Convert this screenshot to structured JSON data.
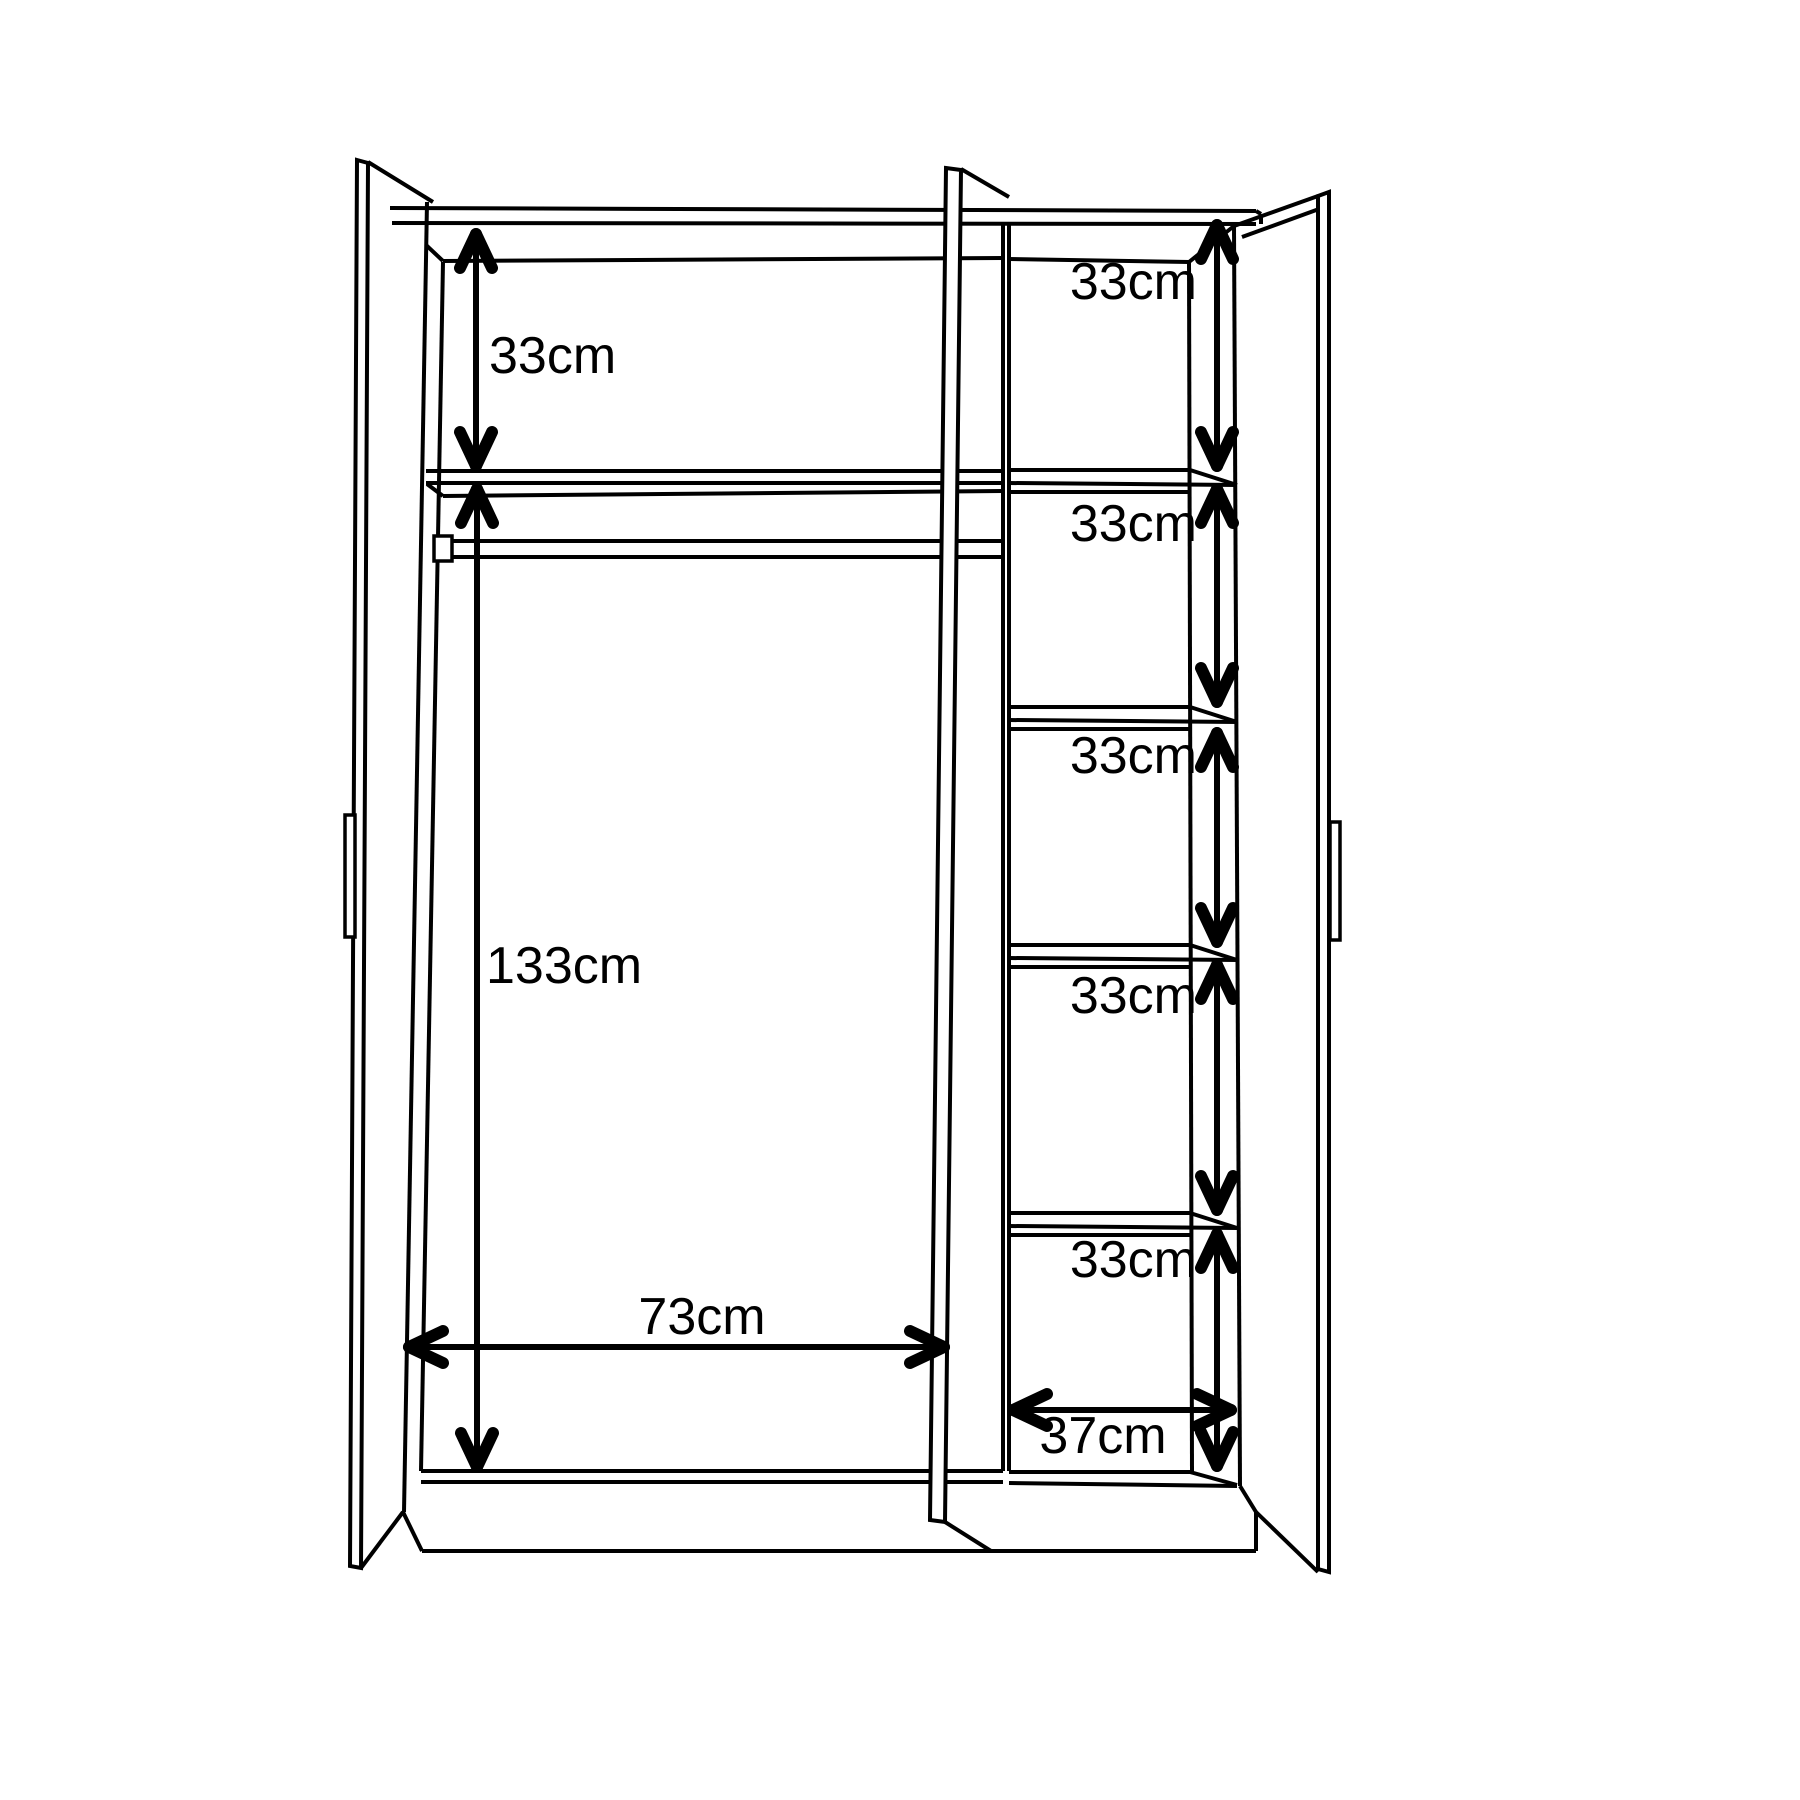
{
  "diagram": {
    "type": "furniture-dimension-drawing",
    "subject": "three-door wardrobe shown open with interior measurements",
    "unit": "cm",
    "colors": {
      "line": "#000000",
      "background": "#ffffff"
    },
    "dimensions": [
      {
        "id": "left-top-compartment-height",
        "label": "33cm",
        "value": 33,
        "orientation": "vertical"
      },
      {
        "id": "left-hanging-space-height",
        "label": "133cm",
        "value": 133,
        "orientation": "vertical"
      },
      {
        "id": "left-compartment-width",
        "label": "73cm",
        "value": 73,
        "orientation": "horizontal"
      },
      {
        "id": "right-shelf-space-1-height",
        "label": "33cm",
        "value": 33,
        "orientation": "vertical"
      },
      {
        "id": "right-shelf-space-2-height",
        "label": "33cm",
        "value": 33,
        "orientation": "vertical"
      },
      {
        "id": "right-shelf-space-3-height",
        "label": "33cm",
        "value": 33,
        "orientation": "vertical"
      },
      {
        "id": "right-shelf-space-4-height",
        "label": "33cm",
        "value": 33,
        "orientation": "vertical"
      },
      {
        "id": "right-shelf-space-5-height",
        "label": "33cm",
        "value": 33,
        "orientation": "vertical"
      },
      {
        "id": "right-compartment-width",
        "label": "37cm",
        "value": 37,
        "orientation": "horizontal"
      }
    ]
  }
}
